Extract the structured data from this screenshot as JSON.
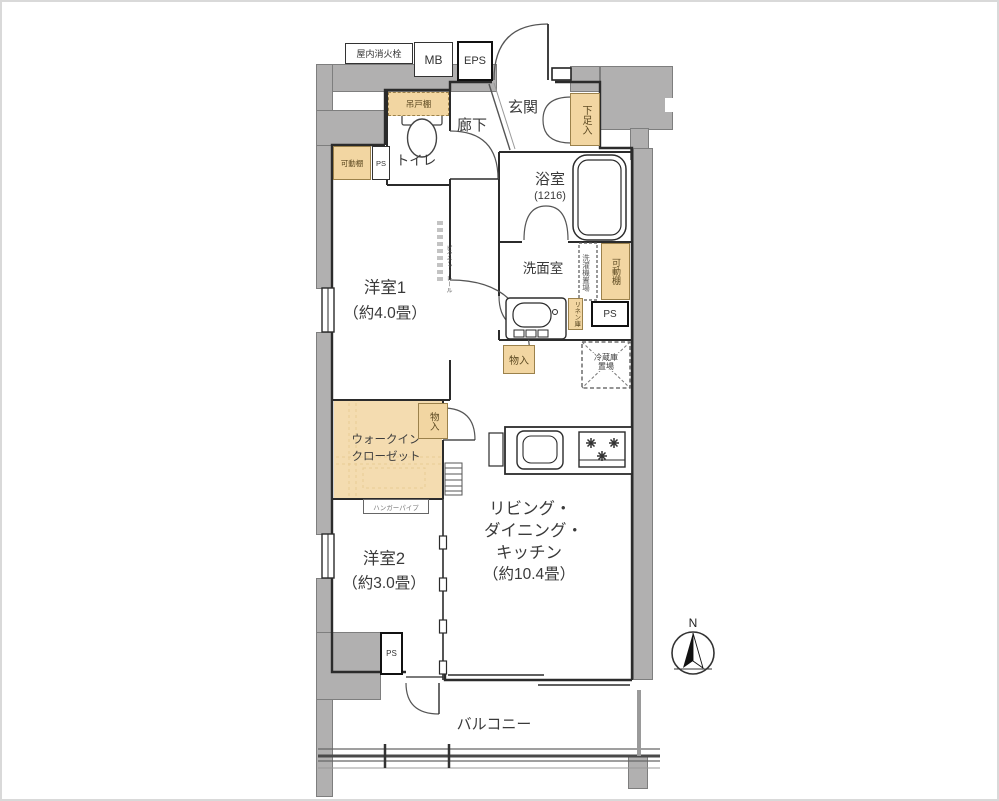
{
  "floorplan": {
    "utility": {
      "fire_hydrant": "屋内消火栓",
      "mb": "MB",
      "eps": "EPS"
    },
    "entrance": {
      "genkan": "玄関",
      "corridor": "廊下",
      "shoe_box": "下足入"
    },
    "toilet": {
      "label": "トイレ",
      "hanging_cupboard": "吊戸棚",
      "movable_shelf": "可動棚",
      "ps": "PS"
    },
    "bathroom": {
      "label": "浴室",
      "size": "(1216)"
    },
    "washroom": {
      "label": "洗面室",
      "washer_space": "洗濯機置場",
      "movable_shelf": "可動棚",
      "linen": "リネン庫",
      "ps": "PS",
      "fridge_line1": "冷蔵庫",
      "fridge_line2": "置場",
      "storage": "物入"
    },
    "bedroom1": {
      "name": "洋室1",
      "size": "（約4.0畳）",
      "picture_rail": "ピクチャーレール"
    },
    "wic": {
      "line1": "ウォークイン",
      "line2": "クローゼット",
      "storage": "物入",
      "hanger_pipe": "ハンガーパイプ"
    },
    "bedroom2": {
      "name": "洋室2",
      "size": "（約3.0畳）"
    },
    "ldk": {
      "line1": "リビング・",
      "line2": "ダイニング・",
      "line3": "キッチン",
      "size": "（約10.4畳）"
    },
    "balcony": {
      "label": "バルコニー",
      "ps": "PS"
    },
    "compass": {
      "north": "N"
    },
    "colors": {
      "wall_gray": "#b1b0b0",
      "closet_tan": "#f2d6a2",
      "line": "#2b2b2b"
    }
  }
}
